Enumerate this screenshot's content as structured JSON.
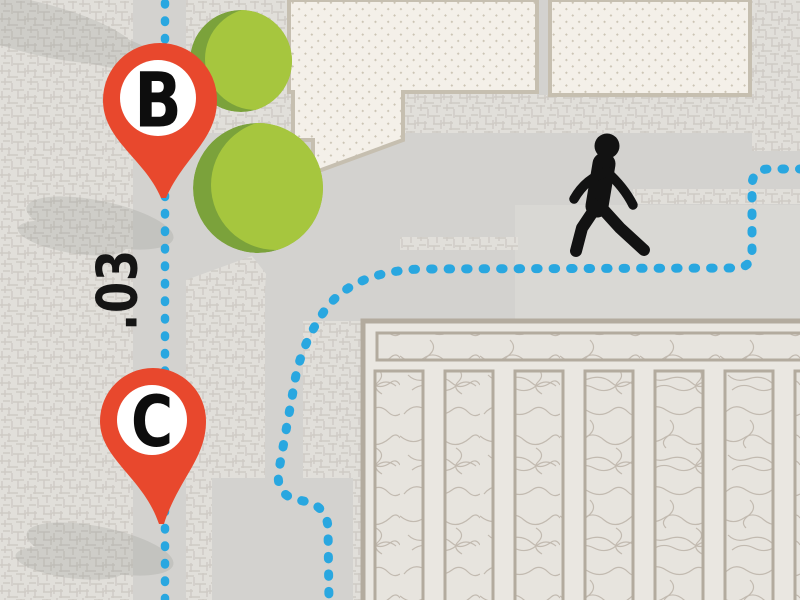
{
  "map": {
    "markers": [
      {
        "id": "pin-b",
        "label": "B"
      },
      {
        "id": "pin-c",
        "label": "C"
      }
    ],
    "distance_label": ".03",
    "route": {
      "style": "dotted",
      "color": "#29a7e0"
    },
    "icons": [
      "map-pin-icon",
      "walking-person-icon",
      "tree-icon",
      "route-dotted-path"
    ],
    "colors": {
      "pin_red": "#e8482d",
      "route_blue": "#29a7e0",
      "tree_light": "#a6c63e",
      "tree_dark": "#7ba23b",
      "road_gray": "#d3d2cf",
      "background_texture": "#e1dfda",
      "building_cream": "#f4f0e9",
      "park_cream": "#eae7e1",
      "border_beige": "#b3ab9e"
    }
  }
}
